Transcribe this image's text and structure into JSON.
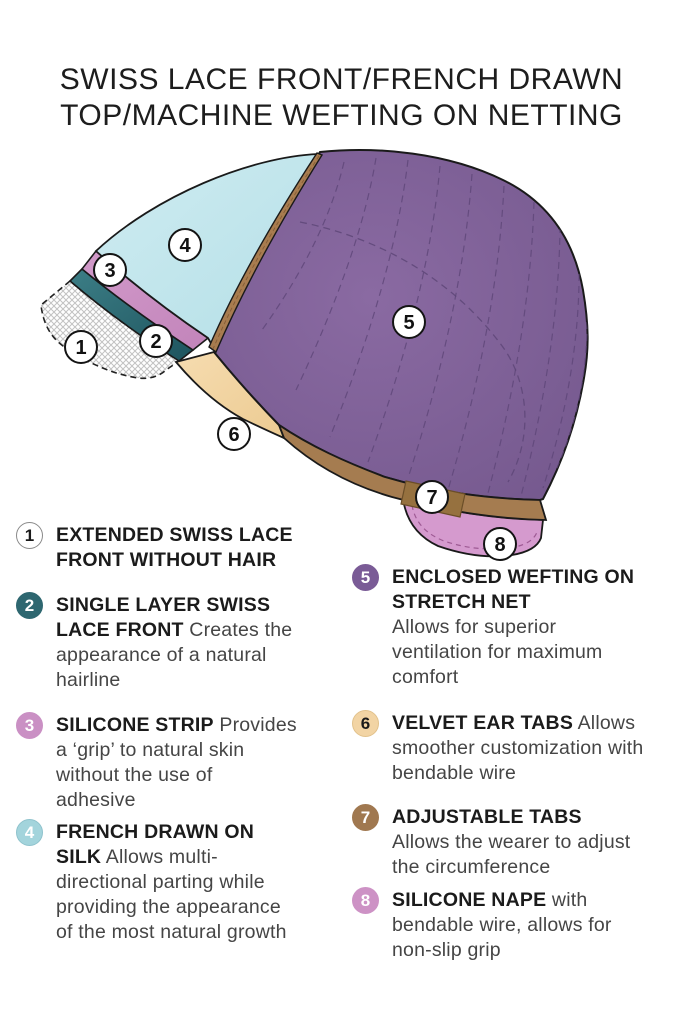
{
  "title": {
    "line1": "SWISS LACE FRONT/FRENCH DRAWN",
    "line2": "TOP/MACHINE WEFTING ON NETTING"
  },
  "colors": {
    "lace_white": "#ffffff",
    "swiss_lace_teal": "#2e6770",
    "silicone_strip_pink": "#ca90c4",
    "french_drawn_cyan": "#c2e6ec",
    "wefting_purple": "#7d5f97",
    "velvet_tab_tan": "#f2d4a4",
    "adjustable_tab_brown": "#a07850",
    "silicone_nape_pink": "#d59ace"
  },
  "diagram": {
    "markers": [
      {
        "label": "1"
      },
      {
        "label": "2"
      },
      {
        "label": "3"
      },
      {
        "label": "4"
      },
      {
        "label": "5"
      },
      {
        "label": "6"
      },
      {
        "label": "7"
      },
      {
        "label": "8"
      }
    ]
  },
  "legend": {
    "items_left": [
      {
        "num": "1",
        "bg": "#ffffff",
        "fg": "#1a1a1a",
        "border": "#8a8a8a",
        "bold": "EXTENDED SWISS LACE FRONT WITHOUT HAIR",
        "rest": ""
      },
      {
        "num": "2",
        "bg": "#2e6770",
        "fg": "#ffffff",
        "border": "#2e6770",
        "bold": "SINGLE LAYER SWISS LACE FRONT",
        "rest": "Creates the appearance of a natural hairline"
      },
      {
        "num": "3",
        "bg": "#ca90c4",
        "fg": "#ffffff",
        "border": "#ca90c4",
        "bold": "SILICONE STRIP",
        "rest": "Provides a ‘grip’ to natural skin without the use of adhesive"
      },
      {
        "num": "4",
        "bg": "#a3d4dc",
        "fg": "#ffffff",
        "border": "#8fc3cd",
        "bold": "FRENCH DRAWN ON SILK",
        "rest": "Allows multi-directional parting while providing the appearance of the most natural growth"
      }
    ],
    "items_right": [
      {
        "num": "5",
        "bg": "#7a5b96",
        "fg": "#ffffff",
        "border": "#7a5b96",
        "bold": "ENCLOSED WEFTING ON STRETCH NET",
        "rest": "Allows for superior ventilation for maximum comfort"
      },
      {
        "num": "6",
        "bg": "#f2d4a4",
        "fg": "#1a1a1a",
        "border": "#e2c28c",
        "bold": "VELVET EAR TABS",
        "rest": "Allows smoother customization with bendable wire"
      },
      {
        "num": "7",
        "bg": "#a07850",
        "fg": "#ffffff",
        "border": "#a07850",
        "bold": "ADJUSTABLE TABS",
        "rest": "Allows the wearer to adjust the circumference"
      },
      {
        "num": "8",
        "bg": "#cd92c5",
        "fg": "#ffffff",
        "border": "#cd92c5",
        "bold": "SILICONE NAPE",
        "rest": "with bendable wire, allows for non-slip grip"
      }
    ]
  }
}
